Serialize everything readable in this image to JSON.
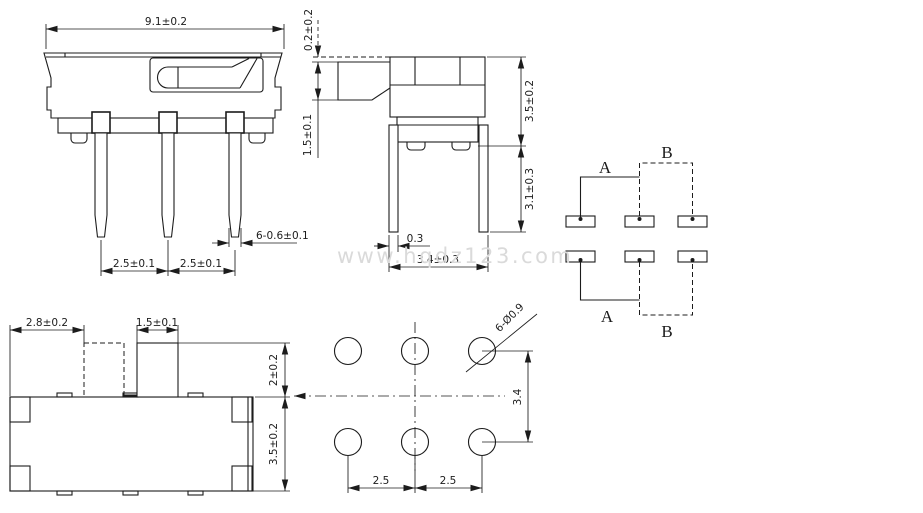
{
  "watermark": {
    "text": "www.hqdz123.com"
  },
  "front_view": {
    "dim_overall_width": "9.1±0.2",
    "dim_pin_pitch_left": "2.5±0.1",
    "dim_pin_pitch_right": "2.5±0.1",
    "dim_pin_width": "6-0.6±0.1"
  },
  "side_view": {
    "dim_knob_top_gap": "0.2±0.2",
    "dim_knob_height": "1.5±0.1",
    "dim_body_height": "3.5±0.2",
    "dim_pin_length": "3.1±0.3",
    "dim_pin_thickness": "0.3",
    "dim_pin_span": "3.4±0.3"
  },
  "top_view": {
    "dim_travel": "2.8±0.2",
    "dim_knob_width": "1.5±0.1",
    "dim_knob_protrusion": "2±0.2",
    "dim_body_depth": "3.5±0.2"
  },
  "pcb_layout": {
    "dim_hole_spec": "6-Ø0.9",
    "dim_row_spacing": "3.4",
    "dim_pitch_left": "2.5",
    "dim_pitch_right": "2.5"
  },
  "schematic": {
    "label_top_a": "A",
    "label_top_b": "B",
    "label_bottom_a": "A",
    "label_bottom_b": "B"
  },
  "colors": {
    "line": "#1c1c1c",
    "watermark": "#dadada",
    "background": "#ffffff"
  }
}
